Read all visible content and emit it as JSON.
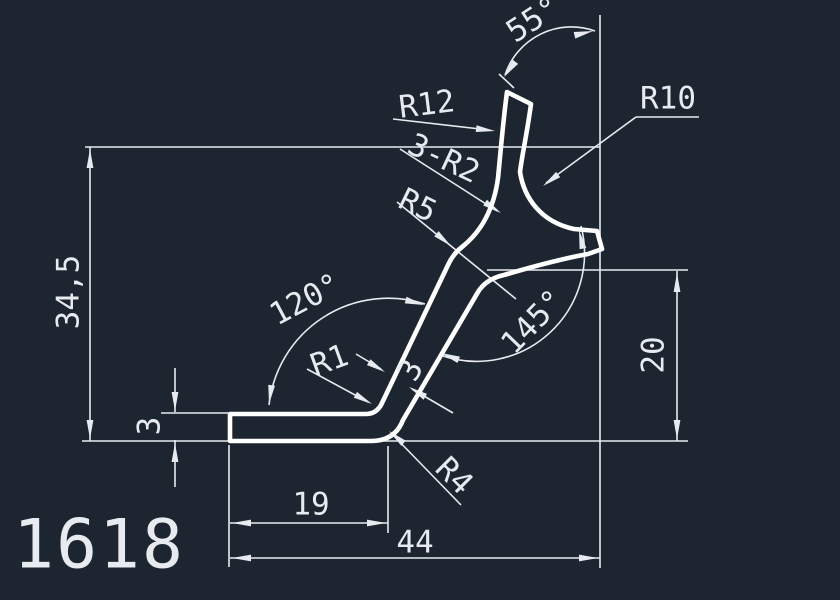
{
  "drawing": {
    "number": "1618",
    "colors": {
      "background": "#1d2530",
      "lines": "#e7ebf0",
      "profile": "#ffffff"
    },
    "labels": {
      "angle_tip": "55°",
      "r12": "R12",
      "r10": "R10",
      "r2_fillets": "3-R2",
      "r5": "R5",
      "total_height": "34,5",
      "angle_bend": "120°",
      "angle_branch": "145°",
      "r1": "R1",
      "arm_thickness": "3",
      "right_height": "20",
      "leg_thickness": "3",
      "r4": "R4",
      "leg_length": "19",
      "total_width": "44"
    }
  }
}
